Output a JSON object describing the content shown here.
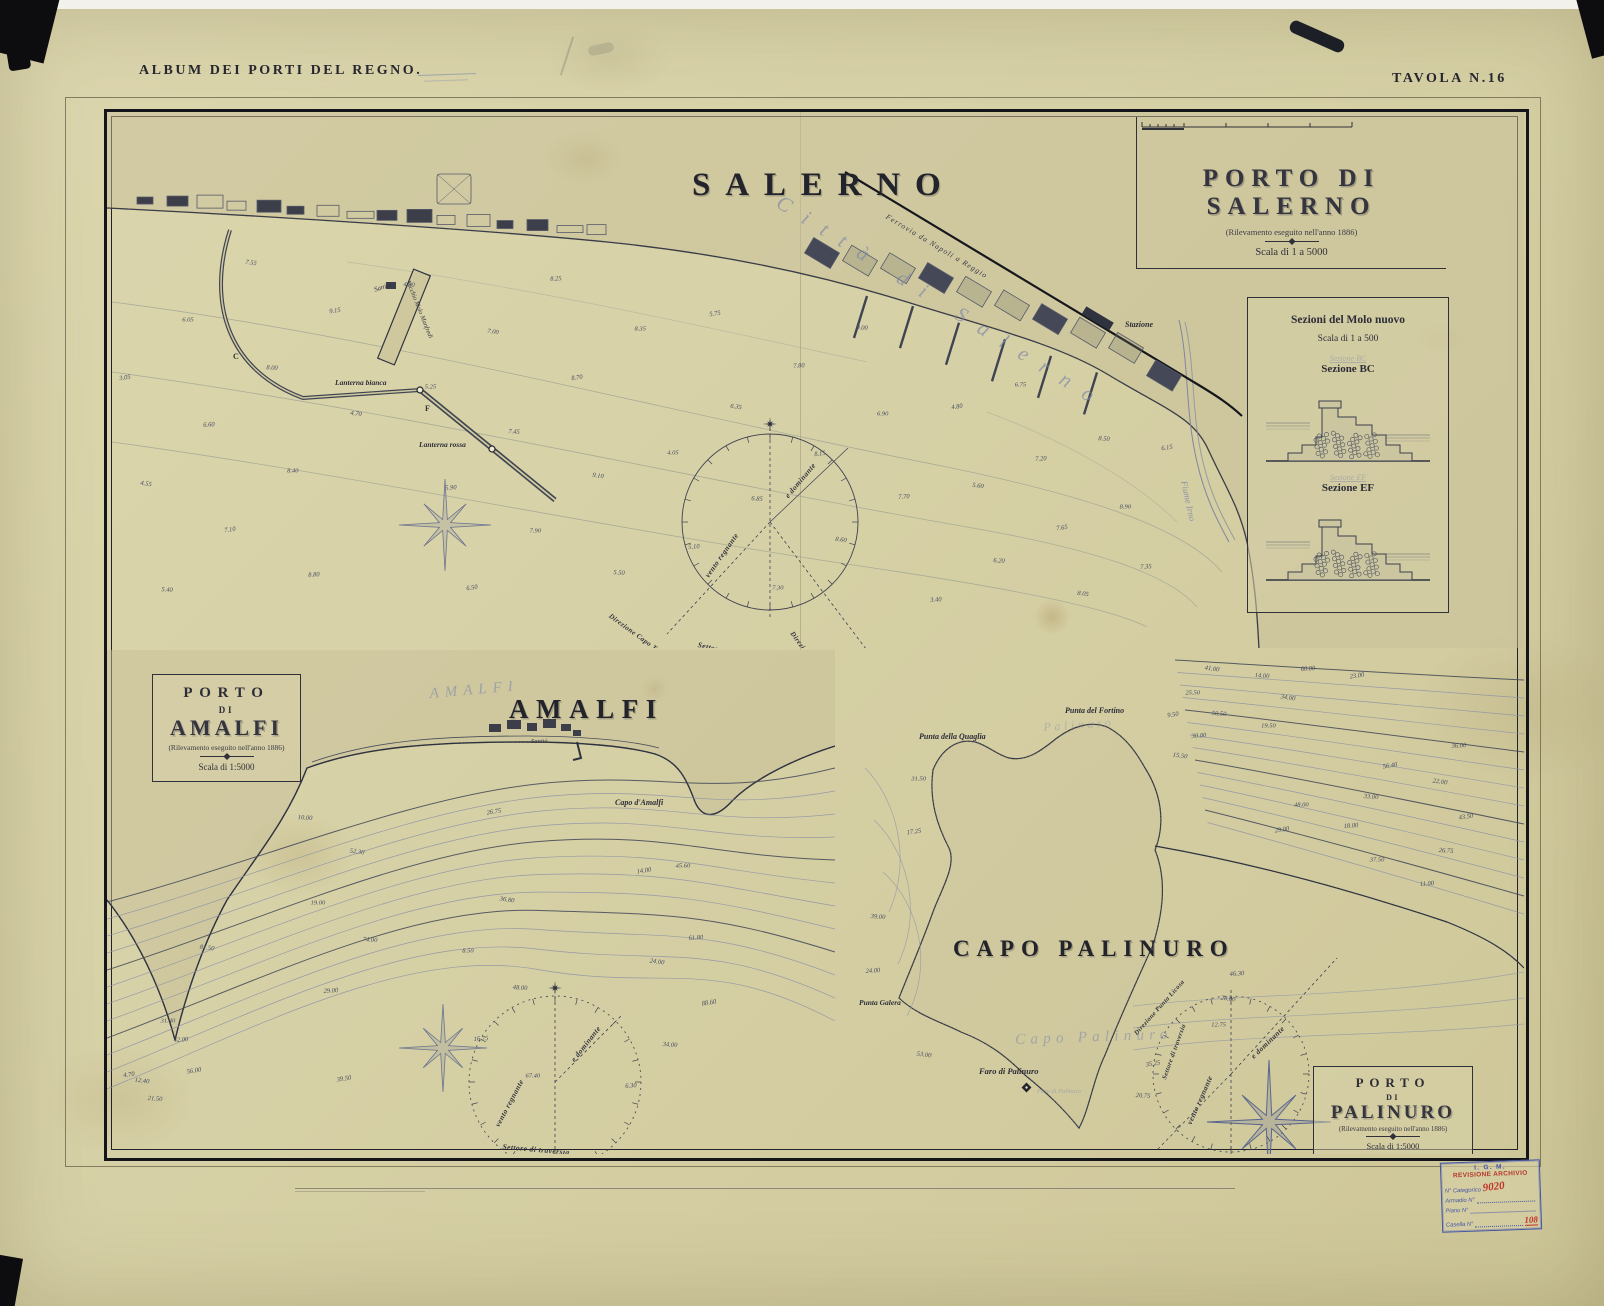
{
  "palette": {
    "paper": "#d7d0a6",
    "ink": "#2e2f38",
    "blue_ink": "#7c88a8",
    "contour": "#8a90a4",
    "pencil": "#80838f",
    "stamp_red": "#b5372c",
    "stamp_blue": "#4455a5"
  },
  "page": {
    "album_title": "ALBUM DEI PORTI DEL REGNO.",
    "plate_label": "TAVOLA N.16"
  },
  "salerno": {
    "city_label": "SALERNO",
    "title": "PORTO DI SALERNO",
    "subtitle": "(Rilevamento eseguito nell'anno 1886)",
    "scale_label": "Scala di 1 a 5000",
    "labels": {
      "sanita": "Sanità",
      "vecchio_molo": "Vecchio Molo Manfredi",
      "lanterna_bianca": "Lanterna bianca",
      "lanterna_rossa": "Lanterna rossa",
      "stazione": "Stazione",
      "ferrovia": "Ferrovia  da  Napoli  a  Reggio",
      "citta": "Città di Salerno",
      "fiume": "Fiume Irno",
      "pt_c": "C",
      "pt_f": "F"
    },
    "compass": {
      "dir_capo_tumolo": "Direzione Capo Tumolo",
      "dir_punta_licosa": "Direzione Punta Licosa",
      "settore": "Settore di traversia",
      "vento": "vento regnante",
      "dominante": "e dominante"
    },
    "soundings": [
      "3.05",
      "3.40",
      "4.05",
      "4.30",
      "4.55",
      "4.80",
      "5.10",
      "5.25",
      "5.40",
      "5.60",
      "5.75",
      "5.90",
      "6.05",
      "6.20",
      "6.35",
      "6.50",
      "6.60",
      "6.75",
      "6.85",
      "7.00",
      "7.10",
      "7.20",
      "7.30",
      "7.45",
      "7.55",
      "7.65",
      "7.80",
      "7.90",
      "8.00",
      "8.05",
      "8.15",
      "8.25",
      "8.40",
      "8.50",
      "8.60",
      "8.70",
      "8.80",
      "8.90",
      "9.00",
      "9.10",
      "9.15",
      "7.35",
      "6.90",
      "5.50",
      "4.70",
      "6.15",
      "7.70",
      "8.35"
    ]
  },
  "sezioni": {
    "title": "Sezioni del Molo nuovo",
    "scale_label": "Scala di 1 a 500",
    "section_bc": "Sezione BC",
    "section_ef": "Sezione EF",
    "pencil_bc": "Sezione BC",
    "pencil_ef": "Sezione EF"
  },
  "amalfi": {
    "title_block": {
      "porto": "PORTO",
      "di": "DI",
      "name": "AMALFI",
      "subtitle": "(Rilevamento eseguito nell'anno 1886)",
      "scale": "Scala di 1:5000"
    },
    "map_label": "AMALFI",
    "cursive_label": "AMALFI",
    "sanita": "Sanità",
    "capo": "Capo d'Amalfi",
    "compass": {
      "vento": "vento regnante",
      "dominante": "e dominante",
      "settore": "Settore di traversia"
    },
    "soundings": [
      "4.70",
      "6.30",
      "8.50",
      "10.00",
      "12.40",
      "14.00",
      "16.75",
      "19.00",
      "21.50",
      "24.00",
      "26.75",
      "29.00",
      "31.40",
      "34.00",
      "36.80",
      "39.50",
      "42.00",
      "45.60",
      "48.00",
      "52.30",
      "56.00",
      "61.80",
      "67.40",
      "74.00",
      "81.50",
      "88.60"
    ]
  },
  "palinuro": {
    "title_block": {
      "porto": "PORTO",
      "di": "DI",
      "name": "PALINURO",
      "subtitle": "(Rilevamento eseguito nell'anno 1886)",
      "scale": "Scala di 1:5000"
    },
    "map_label": "CAPO PALINURO",
    "punta_quaglia": "Punta della Quaglia",
    "punta_fortino": "Punta del Fortino",
    "punta_galera": "Punta Galera",
    "faro": "Faro di Palinuro",
    "faro_cursive": "Faro di Palinuro",
    "cursive_capo": "Capo Palinuro",
    "cursive_palinuro": "Palinuro",
    "compass": {
      "dir_punta_licosa": "Direzione Punta Licosa",
      "settore": "Settore di traversia",
      "vento": "vento regnante",
      "dominante": "e dominante"
    },
    "soundings": [
      "9.50",
      "11.00",
      "12.75",
      "14.00",
      "15.50",
      "17.25",
      "18.00",
      "19.50",
      "20.75",
      "22.00",
      "23.00",
      "24.00",
      "25.50",
      "26.75",
      "28.00",
      "29.00",
      "30.00",
      "31.50",
      "33.00",
      "34.00",
      "35.25",
      "36.00",
      "37.50",
      "39.00",
      "41.00",
      "43.50",
      "46.30",
      "48.00",
      "50.50",
      "53.00",
      "56.40",
      "60.00"
    ]
  },
  "stamp": {
    "line1": "I. G. M.",
    "line2": "REVISIONE ARCHIVIO",
    "cat_label": "N° Categorico",
    "cat_value": "9020",
    "armadio": "Armadio  N°",
    "piano": "Piano  N°",
    "casella": "Casella  N°",
    "casella_value": "108"
  }
}
